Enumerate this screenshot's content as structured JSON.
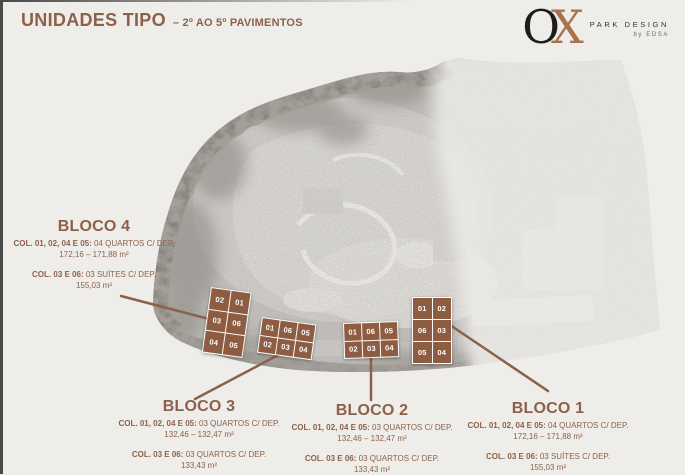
{
  "header": {
    "title": "UNIDADES TIPO",
    "subtitle": "– 2º AO 5º PAVIMENTOS"
  },
  "logo": {
    "o": "O",
    "x": "X",
    "brand": "PARK DESIGN",
    "byline": "by EDSA"
  },
  "colors": {
    "accent": "#8d6149",
    "block_fill": "#8e5c41",
    "logo_copper": "#a9724d",
    "logo_ink": "#1e1d1b",
    "background": "#eeede9"
  },
  "blocks": [
    {
      "name": "BLOCO 4",
      "spec1_label": "COL. 01, 02, 04 E 05:",
      "spec1_value": "04 QUARTOS C/ DEP.",
      "spec1_area": "172,16 – 171,88 m²",
      "spec2_label": "COL. 03 E 06:",
      "spec2_value": "03 SUÍTES C/ DEP.",
      "spec2_area": "155,03 m²",
      "grid_cols": 2,
      "cells": [
        "02",
        "01",
        "03",
        "06",
        "04",
        "05"
      ]
    },
    {
      "name": "BLOCO 3",
      "spec1_label": "COL. 01, 02, 04 E 05:",
      "spec1_value": "03 QUARTOS C/ DEP.",
      "spec1_area": "132,46 – 132,47 m²",
      "spec2_label": "COL. 03 E 06:",
      "spec2_value": "03 QUARTOS C/ DEP.",
      "spec2_area": "133,43 m²",
      "grid_cols": 3,
      "cells": [
        "01",
        "06",
        "05",
        "02",
        "03",
        "04"
      ]
    },
    {
      "name": "BLOCO 2",
      "spec1_label": "COL. 01, 02, 04 E 05:",
      "spec1_value": "03 QUARTOS C/ DEP.",
      "spec1_area": "132,46 – 132,47 m²",
      "spec2_label": "COL. 03 E 06:",
      "spec2_value": "03 QUARTOS C/ DEP.",
      "spec2_area": "133,43 m²",
      "grid_cols": 3,
      "cells": [
        "01",
        "06",
        "05",
        "02",
        "03",
        "04"
      ]
    },
    {
      "name": "BLOCO 1",
      "spec1_label": "COL. 01, 02, 04 E 05:",
      "spec1_value": "04 QUARTOS C/ DEP.",
      "spec1_area": "172,16 – 171,88 m²",
      "spec2_label": "COL. 03 E 06:",
      "spec2_value": "03 SUÍTES C/ DEP.",
      "spec2_area": "155,03 m²",
      "grid_cols": 2,
      "cells": [
        "01",
        "02",
        "06",
        "03",
        "05",
        "04"
      ]
    }
  ]
}
